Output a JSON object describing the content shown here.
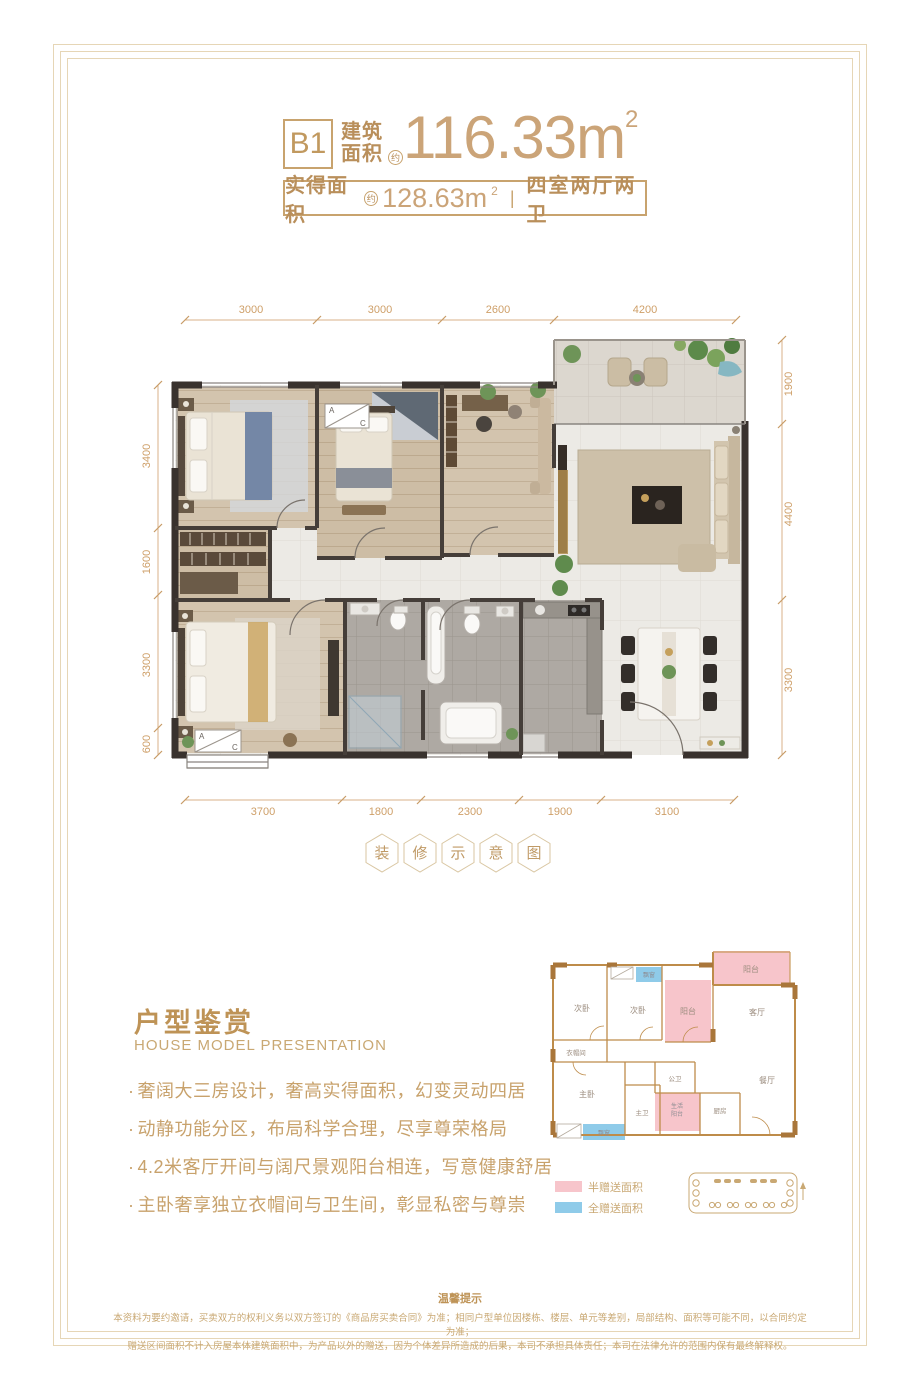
{
  "header": {
    "unit": "B1",
    "type1": "建筑",
    "type2": "面积",
    "approx": "约",
    "value": "116.33m",
    "sup": "2",
    "actual": {
      "label": "实得面积",
      "approx": "约",
      "value": "128.63m",
      "sup": "2",
      "divider": "|",
      "rooms": "四室两厅两卫"
    }
  },
  "floorplan": {
    "dims_top": [
      "3000",
      "3000",
      "2600",
      "4200"
    ],
    "dims_left": [
      "3400",
      "1600",
      "3300",
      "600"
    ],
    "dims_right": [
      "1900",
      "4400",
      "3300"
    ],
    "dims_bottom": [
      "3700",
      "1800",
      "2300",
      "1900",
      "3100"
    ],
    "ac": {
      "a": "A",
      "c": "C"
    }
  },
  "stamp": {
    "chars": [
      "装",
      "修",
      "示",
      "意",
      "图"
    ]
  },
  "section": {
    "title": "户型鉴赏",
    "subtitle": "HOUSE MODEL PRESENTATION",
    "mark": "·",
    "bullets": [
      "奢阔大三房设计，奢高实得面积，幻变灵动四居",
      "动静功能分区，布局科学合理，尽享尊荣格局",
      "4.2米客厅开间与阔尺景观阳台相连，写意健康舒居",
      "主卧奢享独立衣帽间与卫生间，彰显私密与尊崇"
    ]
  },
  "minimap": {
    "rooms": {
      "bed2a": "次卧",
      "bed2b": "次卧",
      "balcony_top": "阳台",
      "balcony_mid": "阳台",
      "living": "客厅",
      "cloak": "衣帽间",
      "master": "主卧",
      "mbath": "主卫",
      "pbath": "公卫",
      "life1": "生活",
      "life2": "阳台",
      "kitchen": "厨房",
      "dining": "餐厅",
      "bay_top": "飘窗",
      "bay_bottom": "飘窗"
    },
    "legend": [
      {
        "label": "半赠送面积",
        "color": "#F7C5CB"
      },
      {
        "label": "全赠送面积",
        "color": "#8FCBE9"
      }
    ]
  },
  "footer": {
    "title": "温馨提示",
    "line1": "本资料为要约邀请，买卖双方的权利义务以双方签订的《商品房买卖合同》为准；相同户型单位因楼栋、楼层、单元等差别，局部结构、面积等可能不同，以合同约定为准；",
    "line2": "赠送区间面积不计入房屋本体建筑面积中，为产品以外的赠送，因为个体差异所造成的后果，本司不承担具体责任；本司在法律允许的范围内保有最终解释权。"
  },
  "colors": {
    "gold_text": "#C8A26C",
    "gold_border": "#C8A36E",
    "dim_text": "#CE9F68",
    "frame": "#E6D6B6",
    "wall_dark": "#39322E",
    "minimap_wall": "#BE8C4A",
    "half_gift_pink": "#F7C5CB",
    "full_gift_blue": "#8FCBE9"
  }
}
